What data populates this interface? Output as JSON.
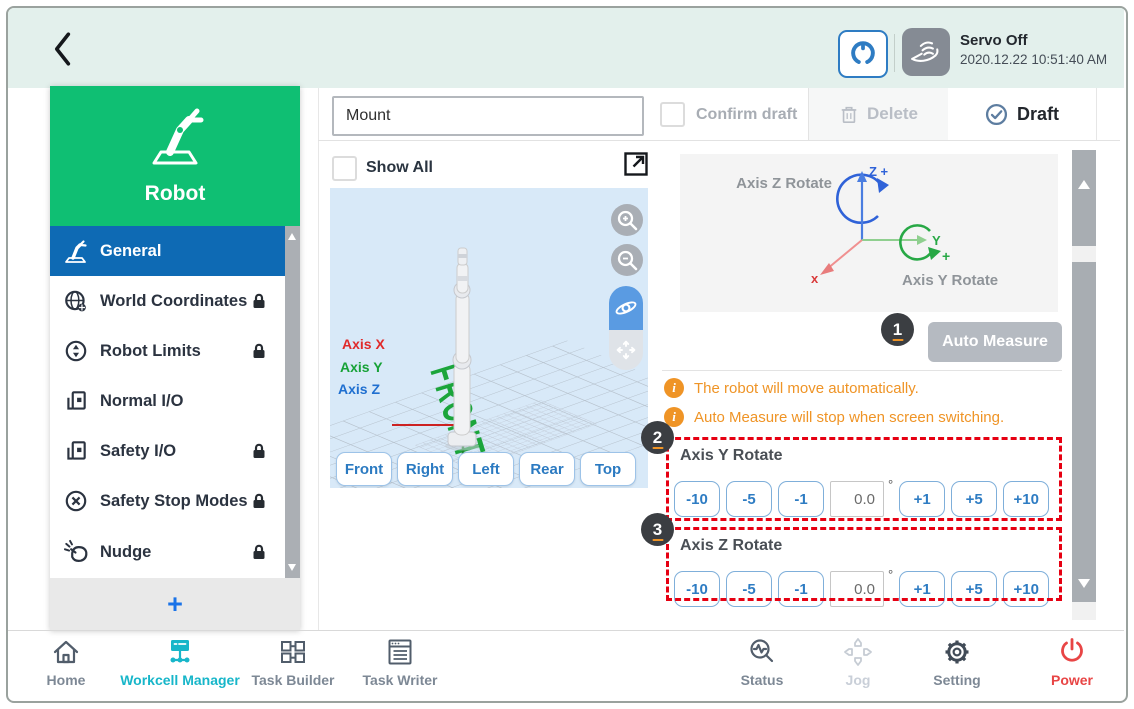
{
  "header": {
    "servo_status": "Servo Off",
    "timestamp": "2020.12.22 10:51:40 AM"
  },
  "sidebar": {
    "title": "Robot",
    "add_label": "+",
    "items": [
      {
        "label": "General",
        "locked": false,
        "active": true
      },
      {
        "label": "World Coordinates",
        "locked": true,
        "active": false
      },
      {
        "label": "Robot Limits",
        "locked": true,
        "active": false
      },
      {
        "label": "Normal I/O",
        "locked": false,
        "active": false
      },
      {
        "label": "Safety I/O",
        "locked": true,
        "active": false
      },
      {
        "label": "Safety Stop Modes",
        "locked": true,
        "active": false
      },
      {
        "label": "Nudge",
        "locked": true,
        "active": false
      }
    ]
  },
  "toolbar": {
    "name_value": "Mount",
    "confirm_draft_label": "Confirm draft",
    "delete_label": "Delete",
    "draft_label": "Draft"
  },
  "viewer": {
    "show_all_label": "Show All",
    "axis_x_label": "Axis X",
    "axis_y_label": "Axis Y",
    "axis_z_label": "Axis Z",
    "floor_label": "FRONT",
    "view_buttons": [
      "Front",
      "Right",
      "Left",
      "Rear",
      "Top"
    ]
  },
  "panel": {
    "diagram": {
      "z_rotate_label": "Axis Z Rotate",
      "y_rotate_label": "Axis Y Rotate",
      "z_axis_label": "Z +",
      "y_axis_label": "Y",
      "y_plus_label": "+",
      "x_axis_label": "x"
    },
    "callouts": {
      "one": "1",
      "two": "2",
      "three": "3"
    },
    "auto_measure_label": "Auto Measure",
    "notes": [
      "The robot will move automatically.",
      "Auto Measure will stop when screen switching."
    ],
    "axis_y": {
      "title": "Axis Y Rotate",
      "minus_buttons": [
        "-10",
        "-5",
        "-1"
      ],
      "value": "0.0",
      "unit": "°",
      "plus_buttons": [
        "+1",
        "+5",
        "+10"
      ]
    },
    "axis_z": {
      "title": "Axis Z Rotate",
      "minus_buttons": [
        "-10",
        "-5",
        "-1"
      ],
      "value": "0.0",
      "unit": "°",
      "plus_buttons": [
        "+1",
        "+5",
        "+10"
      ]
    }
  },
  "bottom_nav": {
    "items": [
      {
        "label": "Home",
        "state": "default"
      },
      {
        "label": "Workcell Manager",
        "state": "active"
      },
      {
        "label": "Task Builder",
        "state": "default"
      },
      {
        "label": "Task Writer",
        "state": "default"
      },
      {
        "label": "Status",
        "state": "default"
      },
      {
        "label": "Jog",
        "state": "disabled"
      },
      {
        "label": "Setting",
        "state": "default"
      },
      {
        "label": "Power",
        "state": "power"
      }
    ]
  },
  "icons": [
    "back-icon",
    "servo-connect-icon",
    "hand-icon",
    "robot-icon",
    "general-icon",
    "world-coordinates-icon",
    "robot-limits-icon",
    "normal-io-icon",
    "safety-io-icon",
    "safety-stop-icon",
    "nudge-icon",
    "lock-icon",
    "expand-icon",
    "zoom-in-icon",
    "zoom-out-icon",
    "orbit-icon",
    "pan-icon",
    "trash-icon",
    "check-circle-icon",
    "info-icon",
    "home-icon",
    "workcell-manager-icon",
    "task-builder-icon",
    "task-writer-icon",
    "status-icon",
    "jog-icon",
    "setting-icon",
    "power-icon"
  ],
  "colors": {
    "header_bg": "#e3f0ec",
    "brand_green": "#0fbf73",
    "selected_blue": "#0e6ab4",
    "button_blue": "#2e7cc3",
    "viewer_bg": "#d8e9f8",
    "active_cyan": "#17b6c9",
    "warning_orange": "#ef9426",
    "callout_red": "#e60012",
    "power_red": "#e84545",
    "auto_measure_gray": "#b5bac1"
  }
}
